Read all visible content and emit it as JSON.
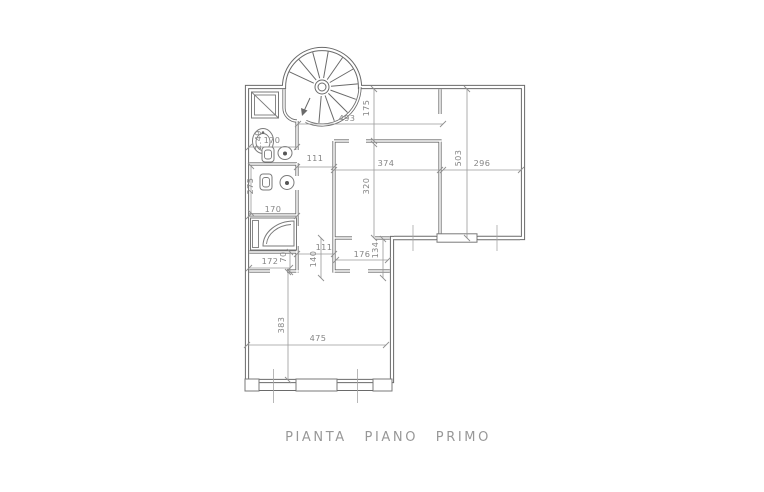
{
  "title": "PIANTA PIANO PRIMO",
  "colors": {
    "wall": "#6a6a6a",
    "dimension_line": "#9a9a9a",
    "dimension_text": "#858585",
    "title_text": "#989898",
    "background": "#ffffff"
  },
  "dims": {
    "d493": "493",
    "d175": "175",
    "d374": "374",
    "d320": "320",
    "d503": "503",
    "d296": "296",
    "d170a": "170",
    "d111a": "111",
    "d275": "275",
    "d249": "2.49",
    "d170b": "170",
    "d111b": "111",
    "d140": "140",
    "d176": "176",
    "d134": "134",
    "d172": "172",
    "d70": "70",
    "d383": "383",
    "d475": "475"
  },
  "fixtures": [
    "spiral-staircase",
    "shower",
    "washbasin",
    "toilet",
    "bidet",
    "corner-bathtub"
  ]
}
